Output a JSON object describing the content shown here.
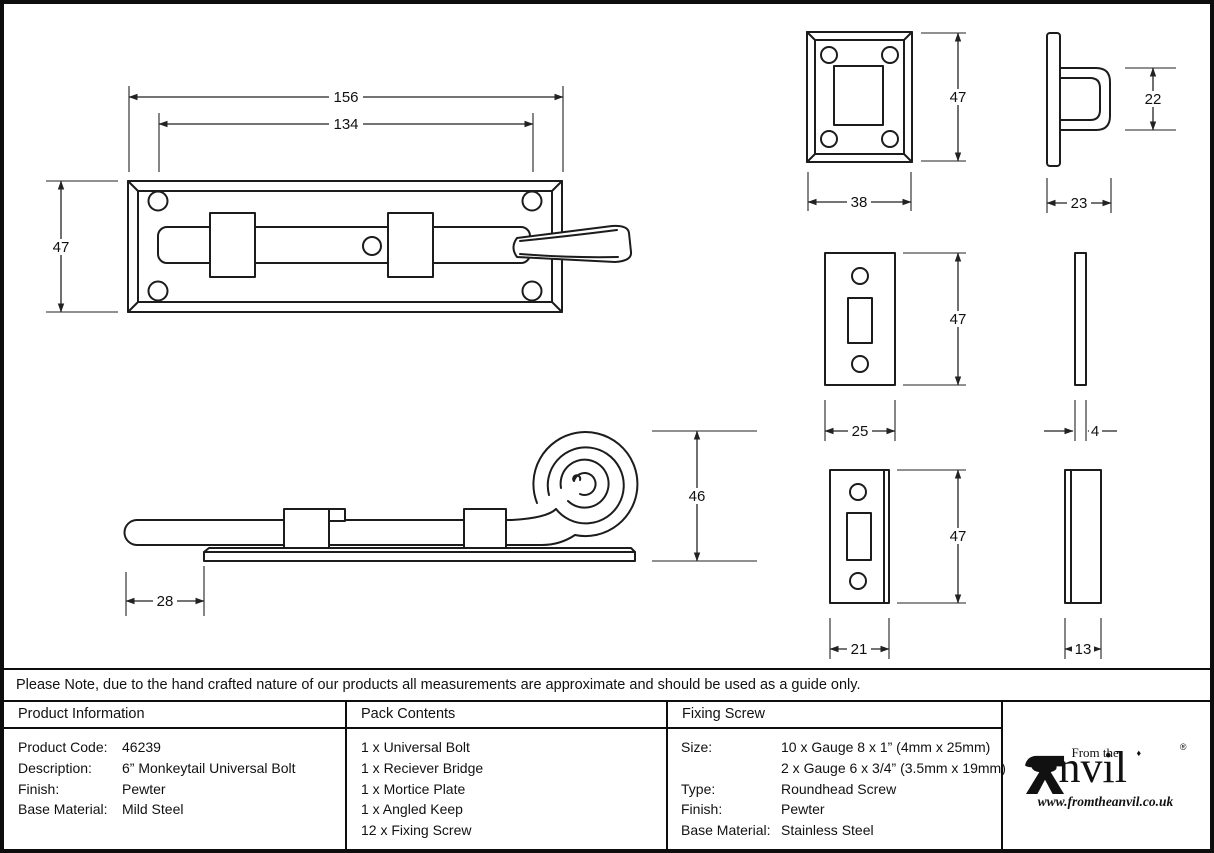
{
  "note": "Please Note, due to the hand crafted nature of our products all measurements are approximate and should be used as a guide only.",
  "table": {
    "product_information": {
      "header": "Product Information",
      "rows": [
        [
          "Product Code:",
          "46239"
        ],
        [
          "Description:",
          "6” Monkeytail Universal Bolt"
        ],
        [
          "Finish:",
          "Pewter"
        ],
        [
          "Base Material:",
          "Mild Steel"
        ]
      ]
    },
    "pack_contents": {
      "header": "Pack Contents",
      "items": [
        "1 x Universal Bolt",
        "1 x Reciever Bridge",
        "1 x Mortice Plate",
        "1 x Angled Keep",
        "12 x Fixing Screw"
      ]
    },
    "fixing_screw": {
      "header": "Fixing Screw",
      "rows": [
        [
          "Size:",
          "10 x Gauge 8 x 1” (4mm x 25mm)"
        ],
        [
          "",
          "2 x Gauge 6 x 3/4” (3.5mm x 19mm)"
        ],
        [
          "Type:",
          "Roundhead Screw"
        ],
        [
          "Finish:",
          "Pewter"
        ],
        [
          "Base Material:",
          "Stainless Steel"
        ]
      ]
    }
  },
  "logo": {
    "prefix": "From the",
    "brand": "Anvil",
    "brand_suffix": "nvil",
    "diamond": "♦",
    "registered": "®",
    "url": "www.fromtheanvil.co.uk"
  },
  "dims": {
    "bolt_overall": "156",
    "bolt_inner": "134",
    "bolt_height": "47",
    "bridge_height": "47",
    "bridge_width": "38",
    "bridge_loop_height": "22",
    "bridge_depth": "23",
    "mortice_height": "47",
    "mortice_width": "25",
    "mortice_thickness": "4",
    "tail_height": "46",
    "tail_offset": "28",
    "keep_height": "47",
    "keep_width": "21",
    "keep_depth": "13"
  },
  "colors": {
    "line": "#1c1c1c",
    "border": "#0d0d0d",
    "background": "#ffffff"
  }
}
